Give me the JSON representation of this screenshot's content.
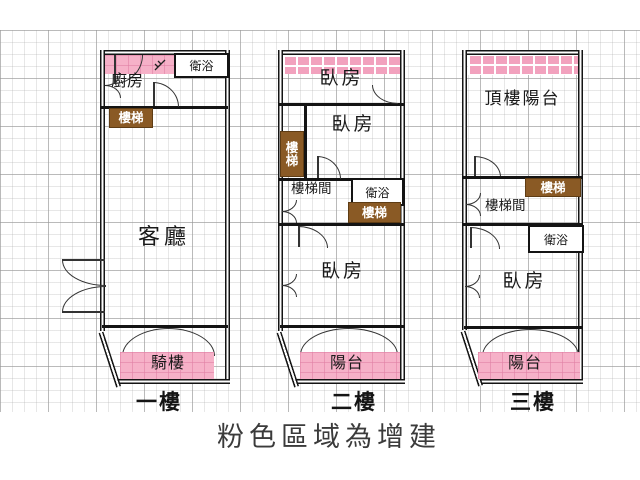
{
  "caption": "粉色區域為增建",
  "floor1": {
    "label": "一樓",
    "bath": "衛浴",
    "kitchen": "廚房",
    "stairs": "樓梯",
    "living": "客廳",
    "arcade": "騎樓"
  },
  "floor2": {
    "label": "二樓",
    "bedroom_top": "臥房",
    "bedroom_mid": "臥房",
    "stairs_side": "樓梯",
    "stairwell": "樓梯間",
    "bath": "衛浴",
    "stairs": "樓梯",
    "bedroom_bottom": "臥房",
    "balcony": "陽台"
  },
  "floor3": {
    "label": "三樓",
    "roof_balcony": "頂樓陽台",
    "stairs": "樓梯",
    "stairwell": "樓梯間",
    "bath": "衛浴",
    "bedroom": "臥房",
    "balcony": "陽台"
  },
  "colors": {
    "addition_pink": "#f6b1c8",
    "stair_brown": "#8a5a25",
    "wall_black": "#141414",
    "caption_gray": "#3b3b3b"
  }
}
